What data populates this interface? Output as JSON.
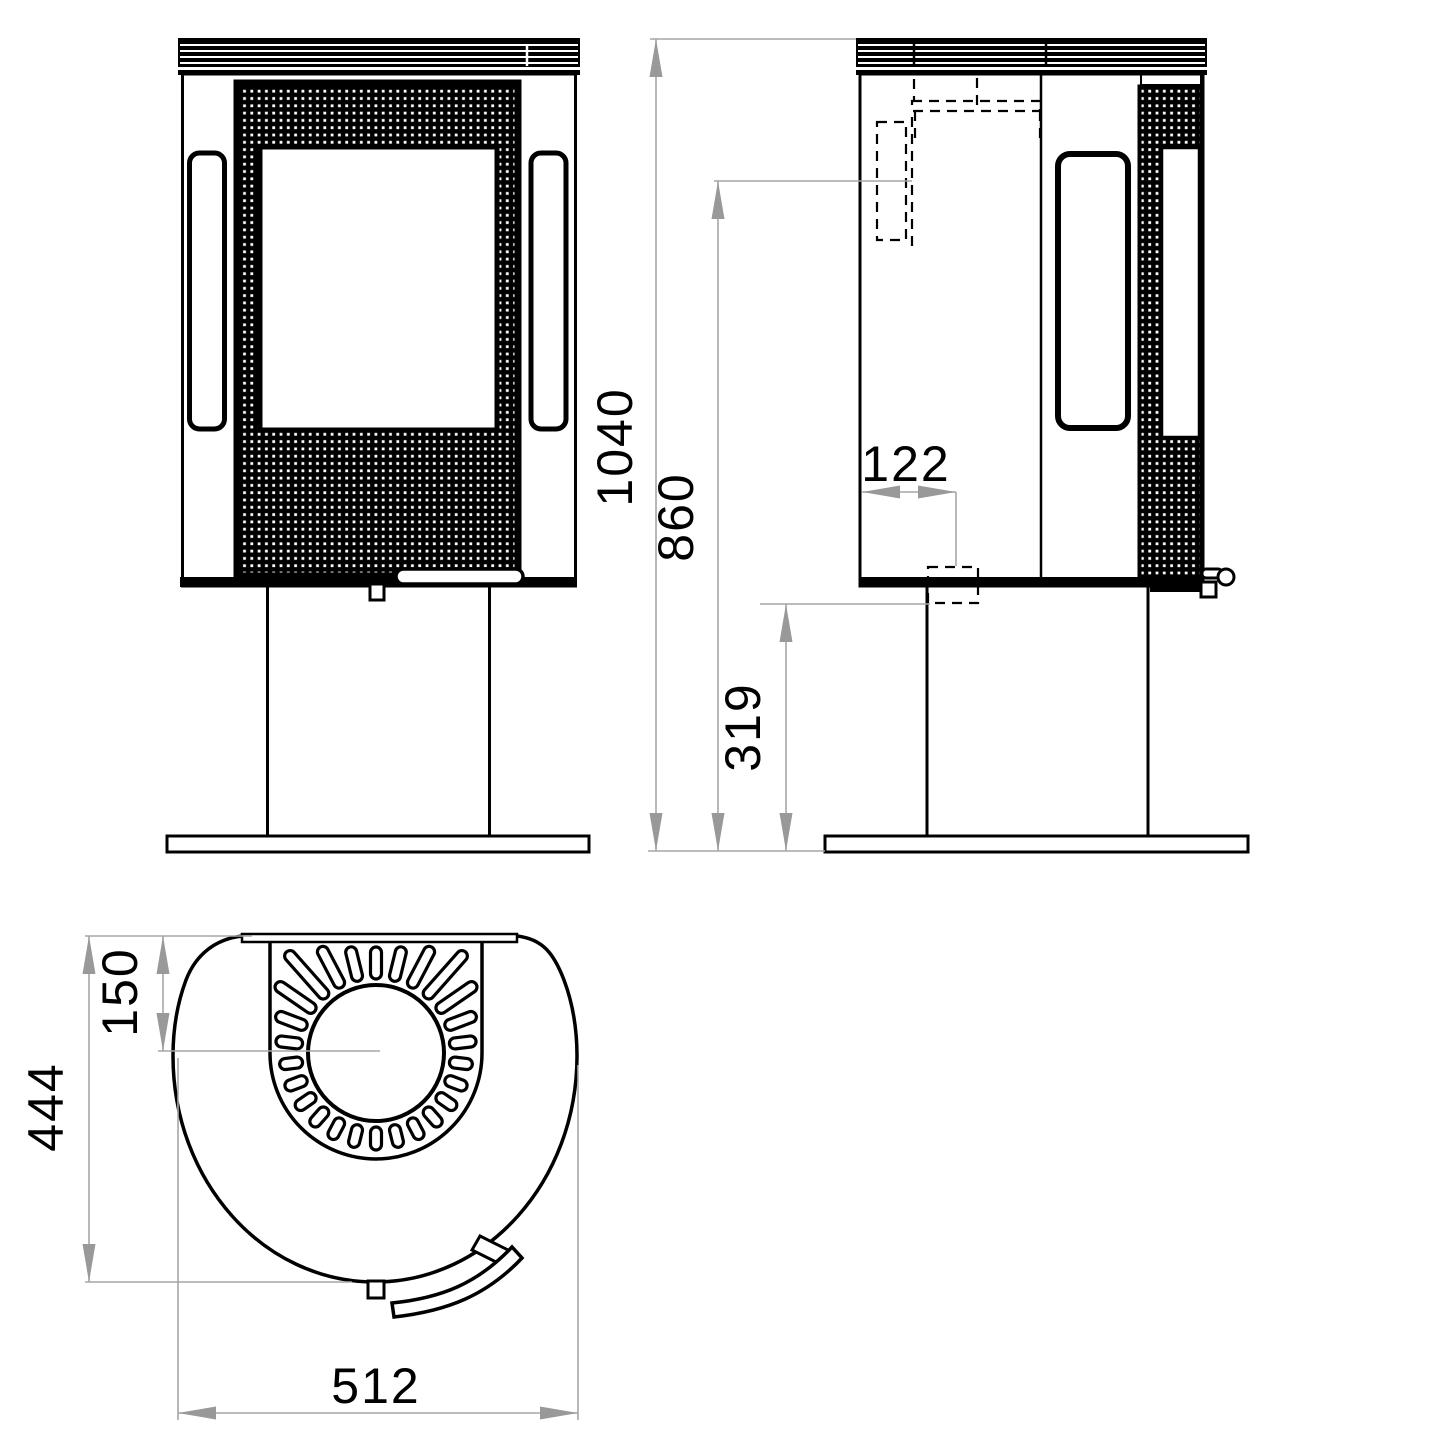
{
  "drawing": {
    "type": "technical-dimension-drawing",
    "views": [
      "front",
      "side",
      "top"
    ],
    "dimensions": {
      "overall_height_mm": "1040",
      "rear_flue_height_mm": "860",
      "lower_connection_height_mm": "319",
      "rear_flue_offset_mm": "122",
      "top_outlet_center_from_back_mm": "150",
      "depth_mm": "444",
      "width_mm": "512"
    },
    "colors": {
      "ink": "#000000",
      "dimension_lines": "#a6a6a6",
      "arrows": "#999999",
      "background": "#ffffff"
    }
  }
}
